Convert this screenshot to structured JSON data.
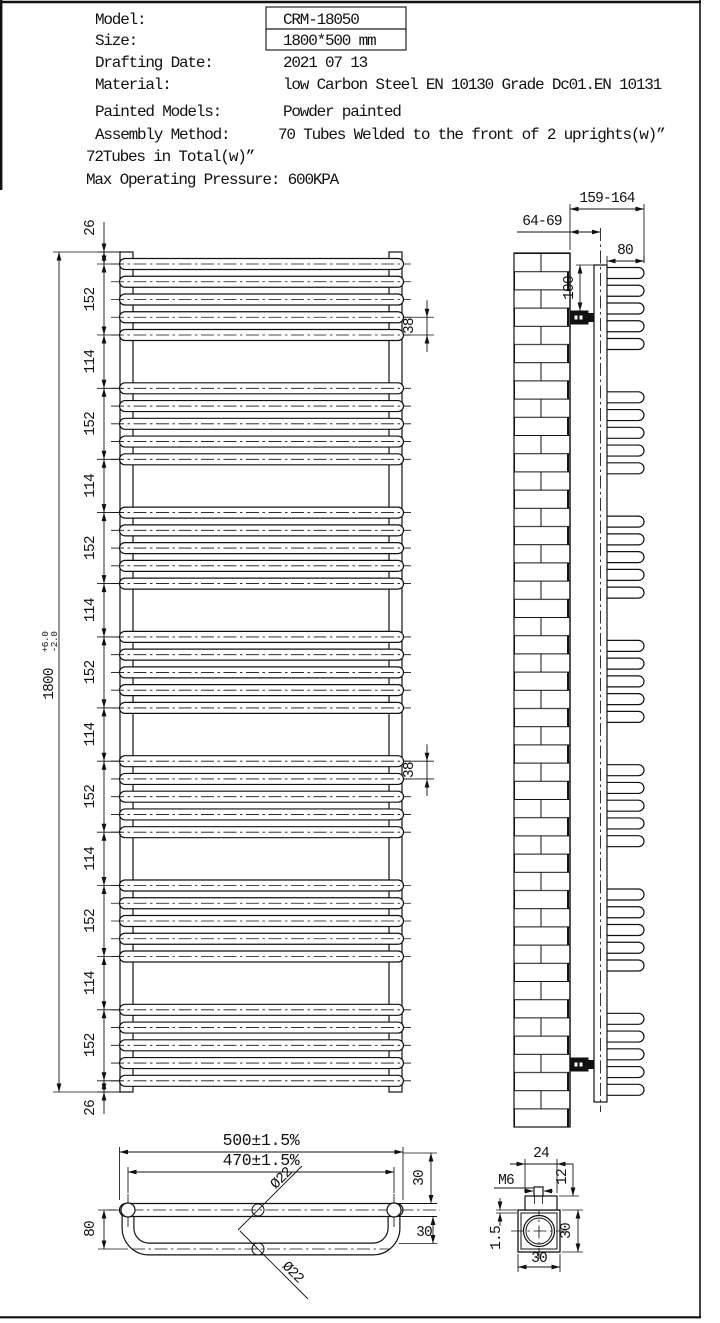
{
  "drawing": {
    "ink": "#111111",
    "paper": "#ffffff"
  },
  "title_block": {
    "rows": [
      {
        "label": "Model:",
        "value": "CRM-18050"
      },
      {
        "label": "Size:",
        "value": "1800*500 mm"
      },
      {
        "label": "Drafting Date:",
        "value": "2021 07 13"
      },
      {
        "label": "Material:",
        "value": "low Carbon Steel  EN 10130 Grade Dc01.EN 10131"
      },
      {
        "label": "Painted Models:",
        "value": "Powder painted"
      },
      {
        "label": "Assembly Method:",
        "value": "70 Tubes Welded to the front of 2 uprights(w)”"
      }
    ],
    "extra_lines": [
      "72Tubes in Total(w)”",
      "Max Operating Pressure: 600KPA"
    ]
  },
  "front_view": {
    "dim_chain": [
      "26",
      "152",
      "114",
      "152",
      "114",
      "152",
      "114",
      "152",
      "114",
      "152",
      "114",
      "152",
      "114",
      "152",
      "26"
    ],
    "overall": {
      "value": "1800",
      "tol_plus": "+6.0",
      "tol_minus": "-2.0"
    },
    "tube_spacing": "38",
    "tube_groups": 7,
    "tubes_per_group": 5
  },
  "side_view": {
    "wall_to_upright": "64-69",
    "overall_depth": "159-164",
    "tube_depth": "80",
    "bracket_offset": "100"
  },
  "bottom_view": {
    "overall_width": "500±1.5%",
    "centers_width": "470±1.5%",
    "tube_dia_front": "Ø22",
    "tube_dia_rear": "Ø22",
    "loop_depth": "80",
    "offset_top": "30",
    "offset_rear": "30"
  },
  "bracket_detail": {
    "plate_width": "24",
    "plate_height": "12",
    "thread": "M6",
    "wall_thickness": "1.5",
    "body_height": "30",
    "body_width": "30"
  }
}
